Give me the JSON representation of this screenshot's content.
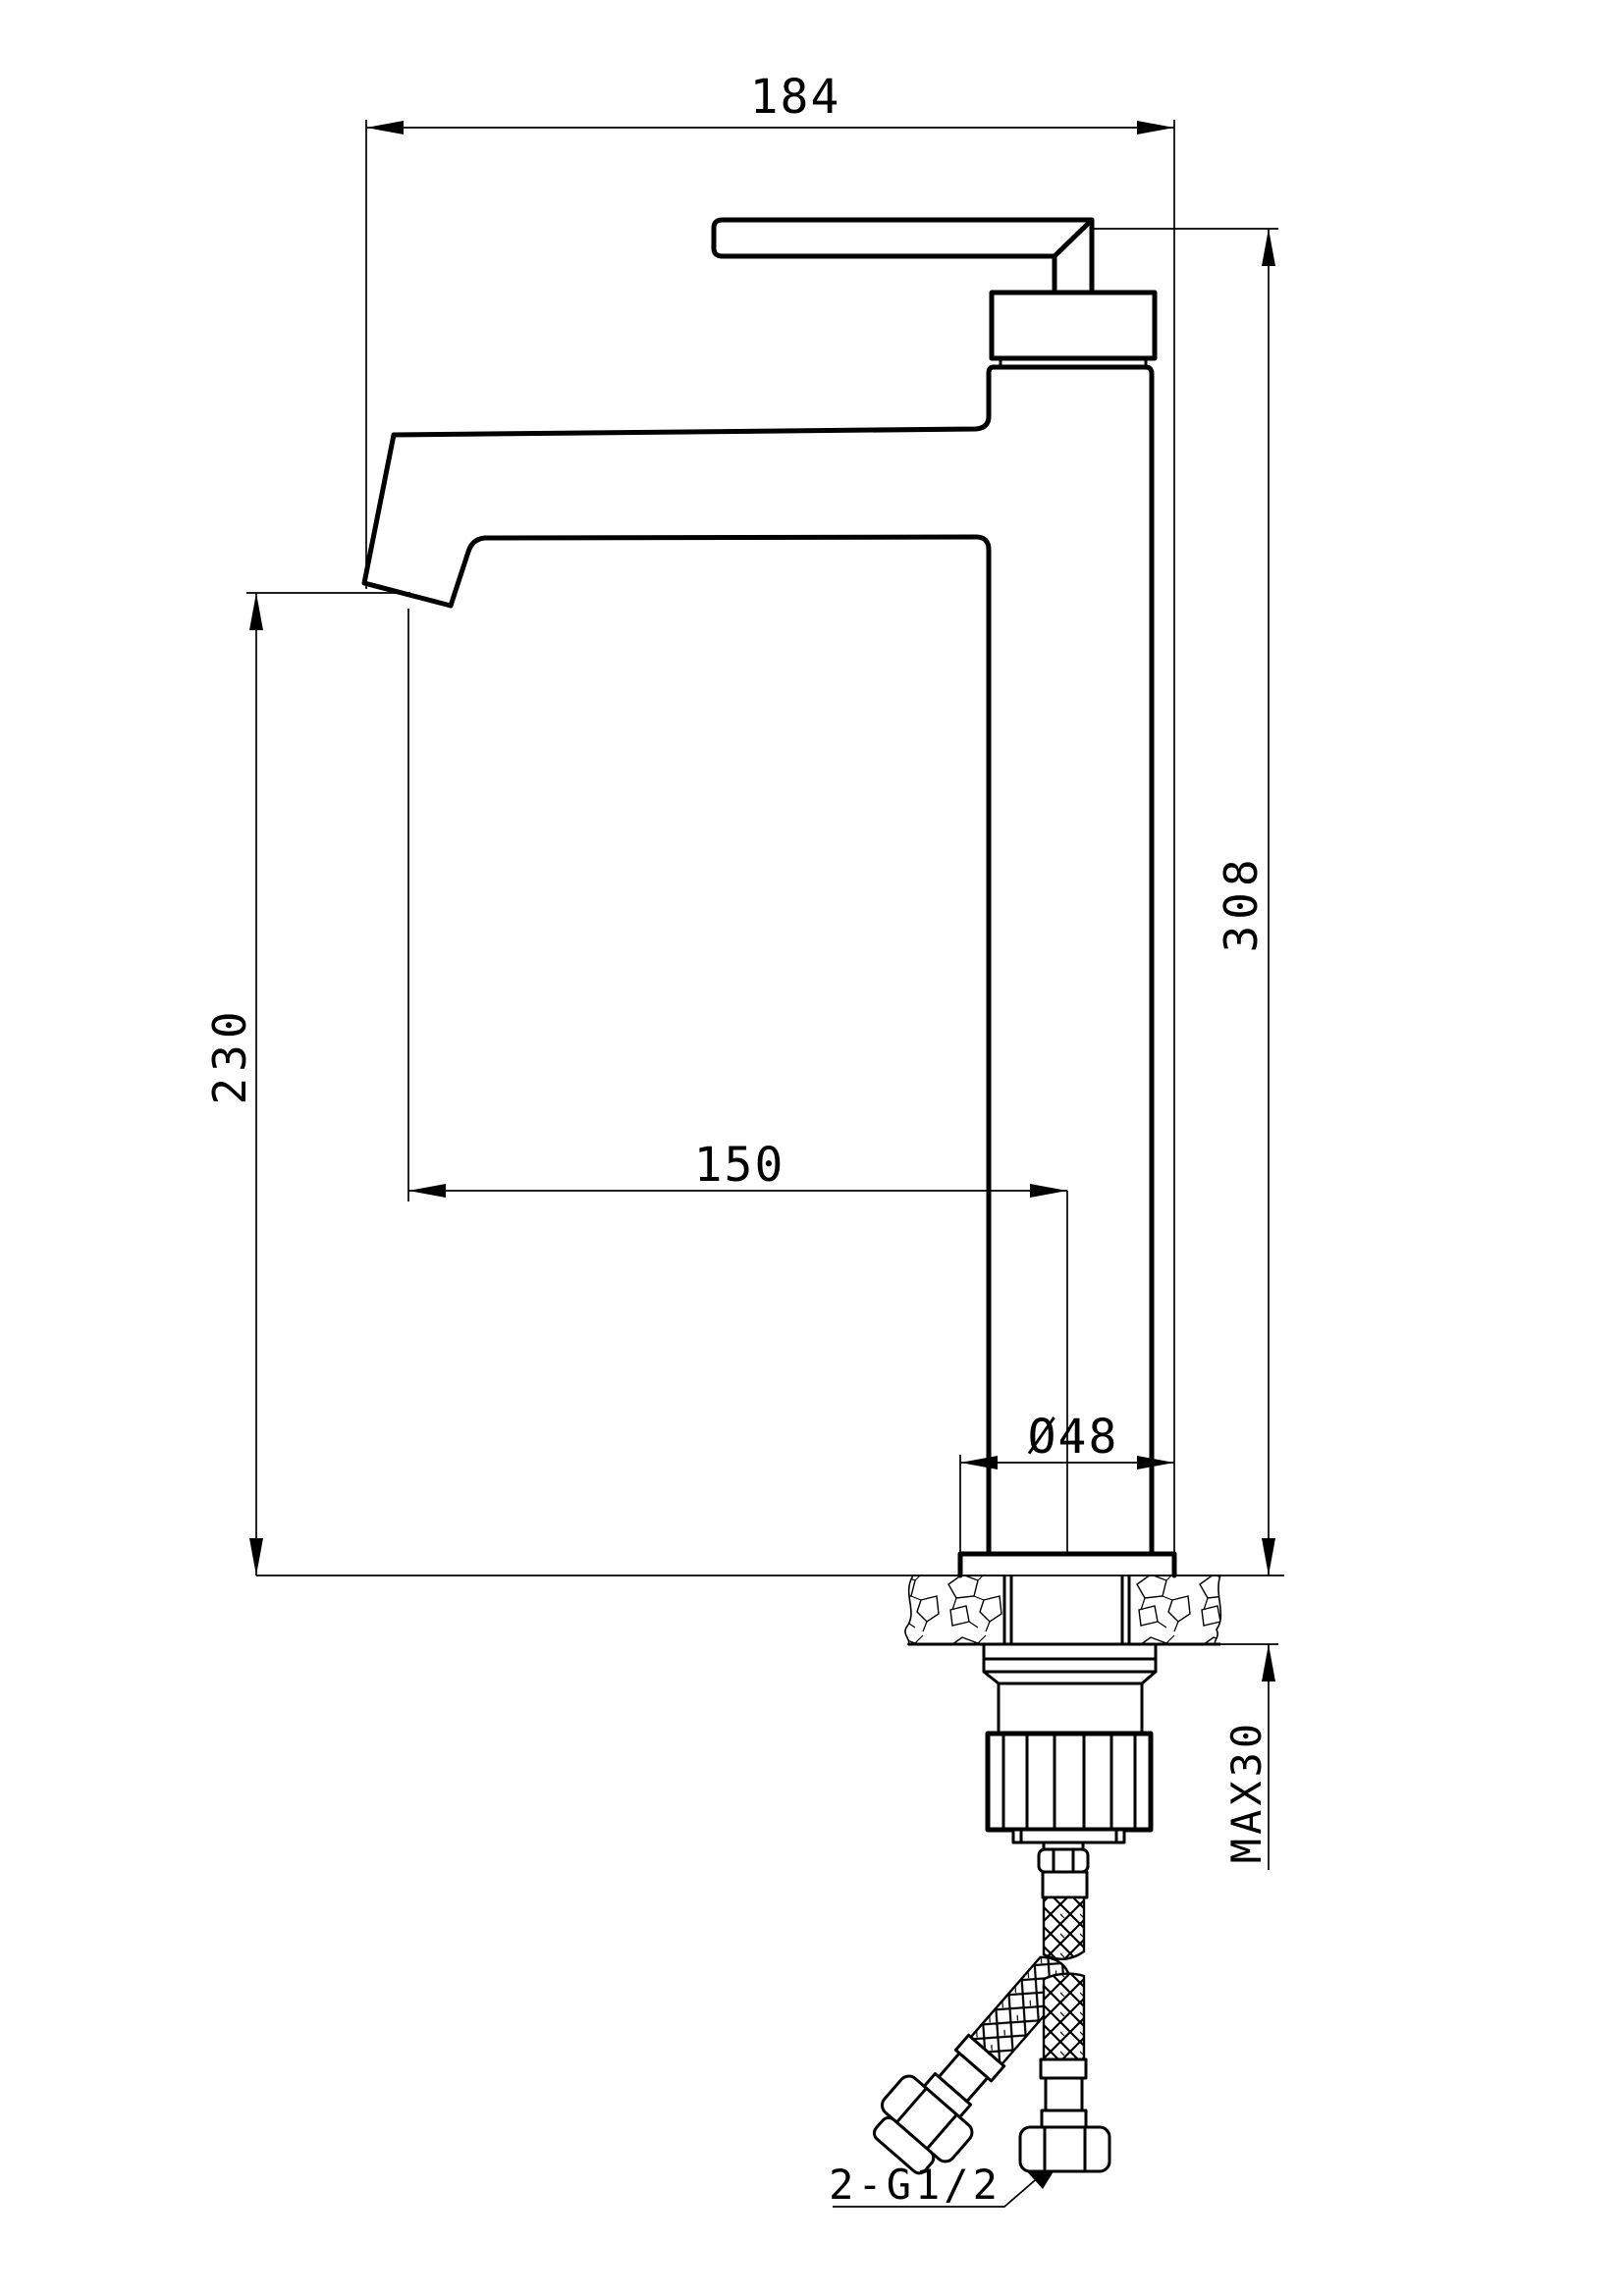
{
  "drawing": {
    "title": "basin mixer faucet installation drawing",
    "type": "technical-dimension-drawing",
    "units": "mm",
    "background_color": "#ffffff",
    "line_color": "#000000",
    "dimensions": {
      "overall_width": "184",
      "overall_height": "308",
      "spout_height": "230",
      "spout_reach": "150",
      "base_diameter": "Ø48",
      "max_deck_thickness": "MAX30",
      "hose_thread": "2-G1/2"
    }
  }
}
